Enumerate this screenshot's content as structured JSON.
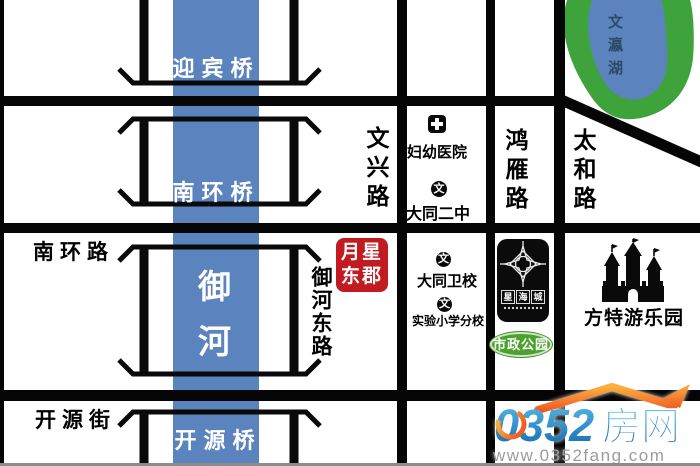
{
  "colors": {
    "river_blue": "#5b83bd",
    "lake_green": "#3fa33c",
    "road_black": "#050505",
    "badge_red": "#c11a20",
    "park_green": "#4da12e",
    "watermark_blue": "#1b79bd",
    "watermark_orange": "#f7941d"
  },
  "river": {
    "char1": "御",
    "char2": "河"
  },
  "bridges": {
    "yingbin": "迎宾桥",
    "nanhuan": "南环桥",
    "kaiyuan": "开源桥"
  },
  "roads": {
    "nanhuan_road": "南环路",
    "kaiyuan_street": "开源街",
    "wenxing_road": "文兴路",
    "hongyan_road": "鸿雁路",
    "taihe_road": "太和路",
    "yuhe_east_road": "御河东路"
  },
  "lake": {
    "name": "文瀛湖"
  },
  "pois": {
    "hospital": {
      "label": "妇幼医院"
    },
    "school2": {
      "label": "大同二中",
      "icon_char": "文"
    },
    "weixiao": {
      "label": "大同卫校",
      "icon_char": "文"
    },
    "primary": {
      "label": "实验小学分校",
      "icon_char": "文"
    },
    "park": {
      "label": "市政公园"
    },
    "amusement": {
      "label": "方特游乐园"
    }
  },
  "property": {
    "line1": "月星",
    "line2": "东郡"
  },
  "logo_box": {
    "char1": "星",
    "char2": "海",
    "char3": "城"
  },
  "watermark": {
    "digits": "0352",
    "cn": "房网",
    "url": "www.0352fang.com"
  }
}
